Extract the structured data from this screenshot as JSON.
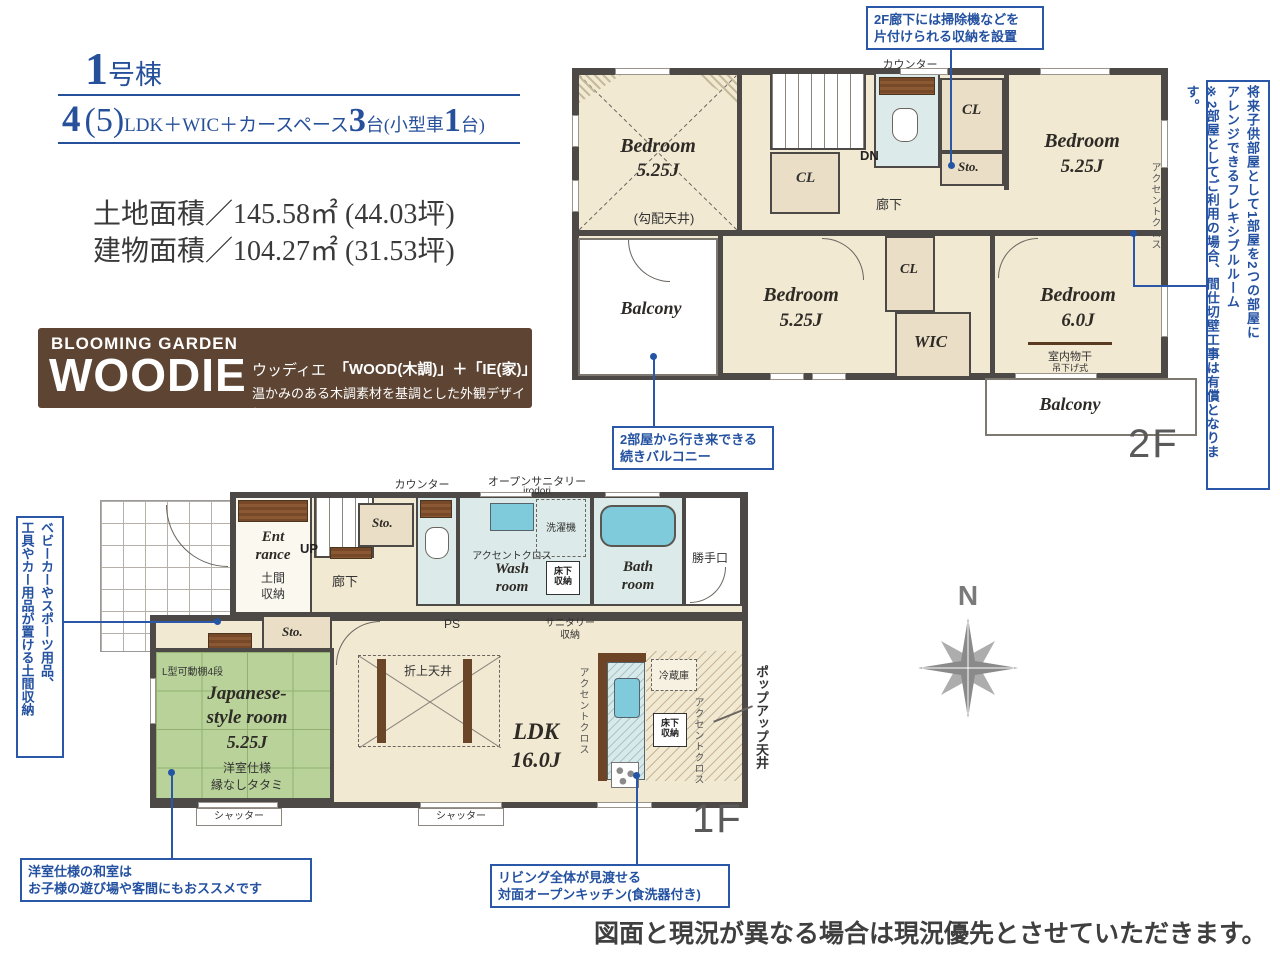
{
  "colors": {
    "accent_blue": "#27509b",
    "callout_blue": "#2b57a8",
    "brand_brown": "#5d4433",
    "wall_gray": "#4d4946",
    "room_cream": "#f2e9d2",
    "closet_beige": "#eadfc6",
    "tatami_green": "#b8d29a",
    "water_blue": "#dcebe9",
    "tub_blue": "#7fcadb",
    "counter_brown": "#774928",
    "compass_gray": "#8d8d8d"
  },
  "header": {
    "unit_big": "1",
    "unit_suffix": "号棟",
    "plan": {
      "p0": "4",
      "p1": "(5)",
      "p2": "LDK＋WIC＋カースペース",
      "p3": "3",
      "p4": "台",
      "p5": "(小型車",
      "p6": "1",
      "p7": "台)"
    },
    "land_area": "土地面積／145.58㎡ (44.03坪)",
    "building_area": "建物面積／104.27㎡ (31.53坪)"
  },
  "brand": {
    "eyebrow": "BLOOMING GARDEN",
    "logo": "WOODIE",
    "reading": "ウッディエ",
    "formula": "「WOOD(木調)」＋「IE(家)」",
    "tagline": "温かみのある木調素材を基調とした外観デザイン"
  },
  "f2": {
    "label": "2F",
    "counter": "カウンター",
    "bedroom_a": {
      "name": "Bedroom",
      "size": "5.25J",
      "note": "(勾配天井)"
    },
    "cl_left": "CL",
    "dn": "DN",
    "hallway": "廊下",
    "cl_right": "CL",
    "sto": "Sto.",
    "bedroom_b": {
      "name": "Bedroom",
      "size": "5.25J"
    },
    "accent": "アクセントクロス",
    "bedroom_c": {
      "name": "Bedroom",
      "size": "5.25J"
    },
    "cl_mid": "CL",
    "wic": "WIC",
    "bedroom_d": {
      "name": "Bedroom",
      "size": "6.0J"
    },
    "laundry": "室内物干",
    "laundry_sub": "吊下げ式",
    "balcony_left": "Balcony",
    "balcony_right": "Balcony"
  },
  "f1": {
    "label": "1F",
    "counter": "カウンター",
    "open_sanitary": "オープンサニタリー",
    "open_sanitary_sub": "irodori",
    "sto_top": "Sto.",
    "washer": "洗濯機",
    "accent_wash": "アクセントクロス",
    "wash_1": "Wash",
    "wash_2": "room",
    "underfloor_1": "床下",
    "underfloor_2": "収納",
    "bath_1": "Bath",
    "bath_2": "room",
    "side_door": "勝手口",
    "entrance_1": "Ent",
    "entrance_2": "rance",
    "doma_1": "土間",
    "doma_2": "収納",
    "up": "UP",
    "hallway": "廊下",
    "sto_mid": "Sto.",
    "ps": "PS",
    "sanitary_1": "サニタリー",
    "sanitary_2": "収納",
    "shelf": "L型可動棚4段",
    "jroom_1": "Japanese-",
    "jroom_2": "style room",
    "jroom_size": "5.25J",
    "tatami_1": "洋室仕様",
    "tatami_2": "縁なしタタミ",
    "oriage": "折上天井",
    "ldk": "LDK",
    "ldk_size": "16.0J",
    "accent_ldk": "アクセントクロス",
    "fridge": "冷蔵庫",
    "underfloor2_1": "床下",
    "underfloor2_2": "収納",
    "accent_kitchen": "アクセントクロス",
    "popup": "ポップアップ天井",
    "shutter_left": "シャッター",
    "shutter_center": "シャッター"
  },
  "callouts": {
    "hallway_storage": [
      "2F廊下には掃除機などを",
      "片付けられる収納を設置"
    ],
    "flexible": [
      "将来子供部屋として1部屋を2つの部屋に",
      "アレンジできるフレキシブルルーム",
      "※2部屋としてご利用の場合、間仕切壁工事は有償となります。"
    ],
    "balcony": [
      "2部屋から行き来できる",
      "続きバルコニー"
    ],
    "doma": [
      "ベビーカーやスポーツ用品、",
      "工具やカー用品が置ける土間収納"
    ],
    "washitsu": [
      "洋室仕様の和室は",
      "お子様の遊び場や客間にもおススメです"
    ],
    "kitchen": [
      "リビング全体が見渡せる",
      "対面オープンキッチン(食洗器付き)"
    ]
  },
  "compass": {
    "n": "N"
  },
  "footer": {
    "disclaimer": "図面と現況が異なる場合は現況優先とさせていただきます。"
  }
}
